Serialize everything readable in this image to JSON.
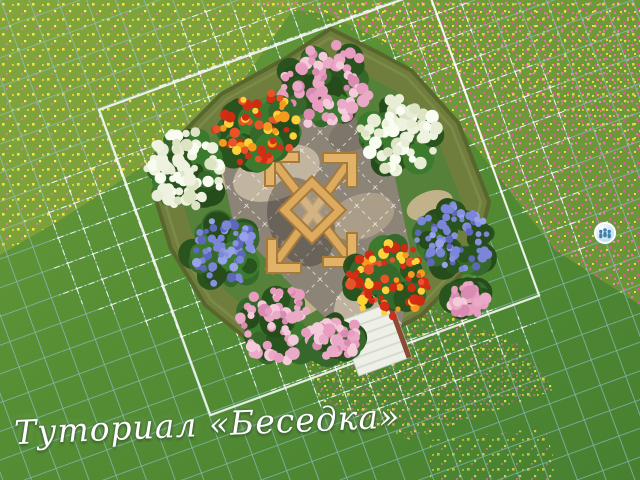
{
  "viewport": {
    "width": 640,
    "height": 480
  },
  "caption": {
    "text": "Туториал «Беседка»"
  },
  "map_tag": {
    "icon": "people-icon",
    "fill": "#cfe9f3",
    "border": "#ffffff",
    "glyph_color": "#3f7fae"
  },
  "palette": {
    "grass_light": "#7ba33c",
    "grass_mid": "#5a9134",
    "grass_dark": "#47802e",
    "meadow_yellow": "#f2df3d",
    "meadow_pink": "#ef6fae",
    "grid_teal": "#8ec2d4",
    "grid_white": "#ffffff",
    "hedge": "#6f7e3d",
    "hedge_dark": "#59672e",
    "garden_ground": "#55813a",
    "soil": "#cdb794",
    "stone": "#8d8478",
    "stone_light": "#cbbda6",
    "wood": "#dcab60",
    "wood_dark": "#a87a38",
    "steps_white": "#eef0e8",
    "steps_edge": "#8a4a33"
  },
  "garden": {
    "center": {
      "x": 320,
      "y": 205
    },
    "rotation_deg": -20,
    "foliage": [
      "#2a541e",
      "#35682a",
      "#274c1b",
      "#3c7a2e"
    ],
    "flower_styles": {
      "pink": {
        "petals": [
          "#eaa9c6",
          "#f4cbdb",
          "#d98bb2",
          "#e79cc0"
        ],
        "size": [
          3,
          6.5
        ]
      },
      "white": {
        "petals": [
          "#eef2df",
          "#f9fcf0",
          "#dce4c4",
          "#e8eed6"
        ],
        "size": [
          3.5,
          7
        ]
      },
      "blue": {
        "petals": [
          "#7b86d8",
          "#98a2e8",
          "#5f67bb",
          "#8890e0"
        ],
        "size": [
          2.5,
          5
        ]
      },
      "redorange": {
        "petals": [
          "#cf2b12",
          "#e8542a",
          "#f59a1d",
          "#ffd23a",
          "#d32f16"
        ],
        "size": [
          2.5,
          5.5
        ]
      }
    },
    "bushes": [
      {
        "type": "pink",
        "x": 325,
        "y": 85,
        "r": 55
      },
      {
        "type": "white",
        "x": 400,
        "y": 135,
        "r": 50
      },
      {
        "type": "redorange",
        "x": 256,
        "y": 128,
        "r": 50
      },
      {
        "type": "white",
        "x": 185,
        "y": 168,
        "r": 52
      },
      {
        "type": "blue",
        "x": 455,
        "y": 240,
        "r": 48
      },
      {
        "type": "blue",
        "x": 224,
        "y": 252,
        "r": 44
      },
      {
        "type": "redorange",
        "x": 388,
        "y": 278,
        "r": 52
      },
      {
        "type": "pink",
        "x": 278,
        "y": 325,
        "r": 48
      },
      {
        "type": "pink",
        "x": 338,
        "y": 338,
        "r": 28
      },
      {
        "type": "pink",
        "x": 468,
        "y": 300,
        "r": 22
      }
    ]
  }
}
